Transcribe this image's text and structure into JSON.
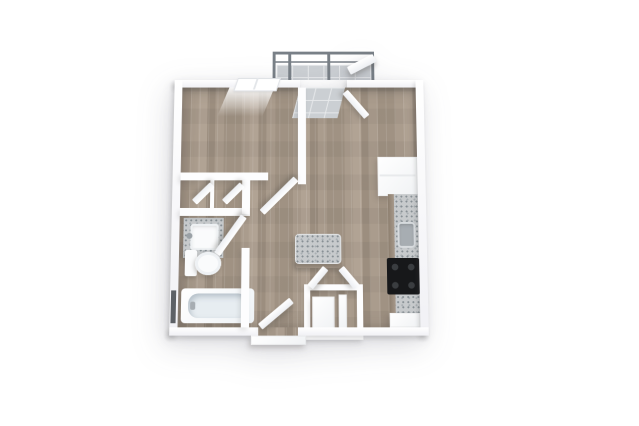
{
  "scene": {
    "kind": "3d-floorplan-render",
    "background": "#ffffff",
    "rooms": [
      {
        "name": "bedroom",
        "floor": "wood",
        "features": [
          "window-top-wall",
          "door-open",
          "closet-double-doors"
        ]
      },
      {
        "name": "living-kitchen",
        "floor": "wood",
        "features": [
          "balcony-door-open",
          "kitchen-island",
          "counter-run",
          "sink",
          "range",
          "refrigerator"
        ]
      },
      {
        "name": "bathroom",
        "floor": "wood",
        "features": [
          "vanity-sink",
          "toilet",
          "bathtub",
          "door-open",
          "slit-window"
        ]
      },
      {
        "name": "hallway",
        "floor": "wood",
        "features": [
          "entry-door-open"
        ]
      },
      {
        "name": "utility-closet",
        "floor": "wood",
        "features": [
          "washer",
          "bifold-doors-open"
        ]
      },
      {
        "name": "balcony",
        "floor": "tile",
        "features": [
          "metal-railing"
        ]
      }
    ],
    "colors": {
      "wall": "#fdfdfe",
      "wallShade": "#f1f1f5",
      "woodA": "#a09283",
      "woodB": "#aa9c8d",
      "woodC": "#b1a394",
      "woodD": "#9c8e7f",
      "tile": "#cbcfd3",
      "tileLine": "#e7e9eb",
      "counter": "#c7cacc",
      "speckDark": "#878f94",
      "speckLight": "#a9afb3",
      "range": "#17181a",
      "burner": "#3a3d40",
      "sinkMetal": "#a7adb2",
      "fixture": "#fafbfc",
      "basin": "#e7edf1",
      "railing": "#798087",
      "slit": "#5d6166"
    }
  }
}
